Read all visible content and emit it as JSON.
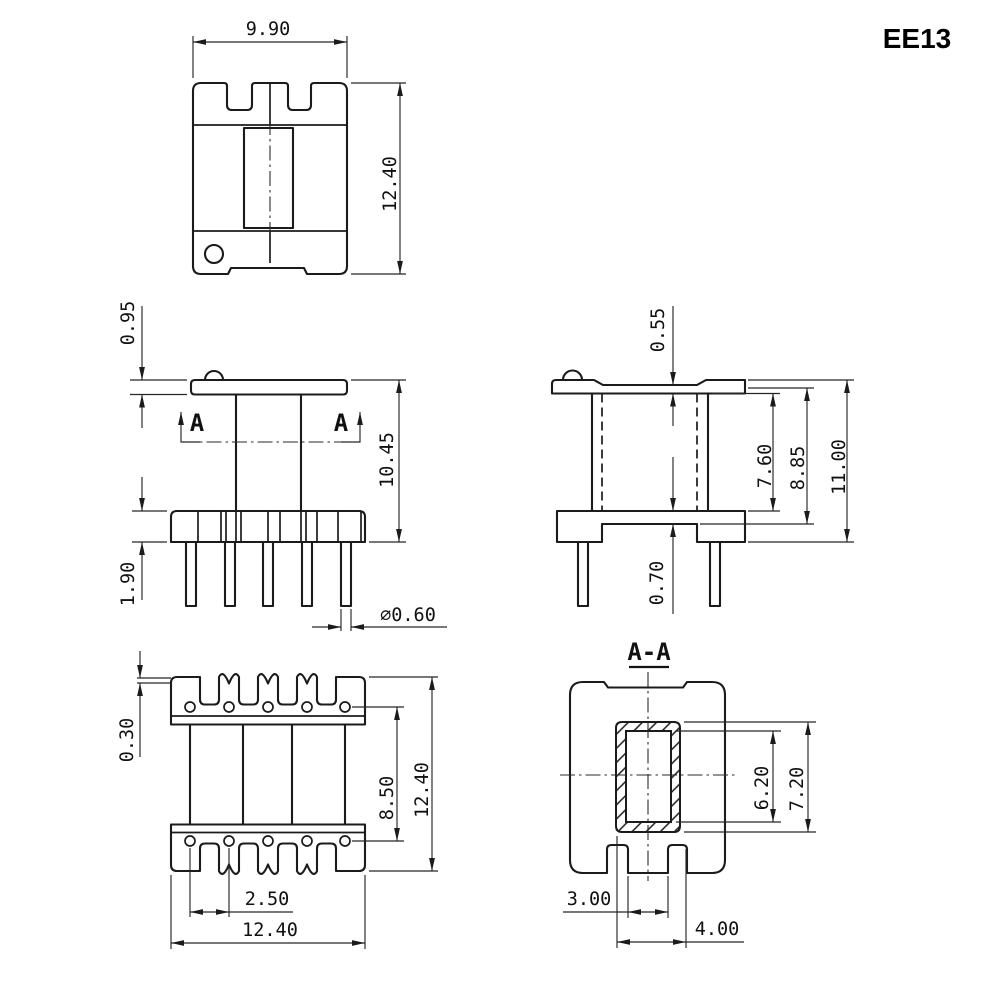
{
  "part_label": "EE13",
  "section": {
    "view_title": "A-A",
    "cutting_plane_label": "A"
  },
  "dimensions": {
    "core_top_view": {
      "width": "9.90",
      "height": "12.40"
    },
    "front_view": {
      "flange_thickness": "0.95",
      "flange_to_base_height": "10.45",
      "base_height": "1.90",
      "pin_diameter": "⌀0.60"
    },
    "side_view": {
      "rim_step": "0.55",
      "winding_window_height": "7.60",
      "body_height": "8.85",
      "overall_height": "11.00",
      "base_plate_thickness": "0.70"
    },
    "top_view": {
      "edge_lip": "0.30",
      "pin_row_spacing": "8.50",
      "overall_height": "12.40",
      "pin_pitch": "2.50",
      "overall_width": "12.40"
    },
    "section_view": {
      "window_height": "6.20",
      "tube_height": "7.20",
      "center_leg_width": "3.00",
      "tube_width": "4.00"
    }
  }
}
